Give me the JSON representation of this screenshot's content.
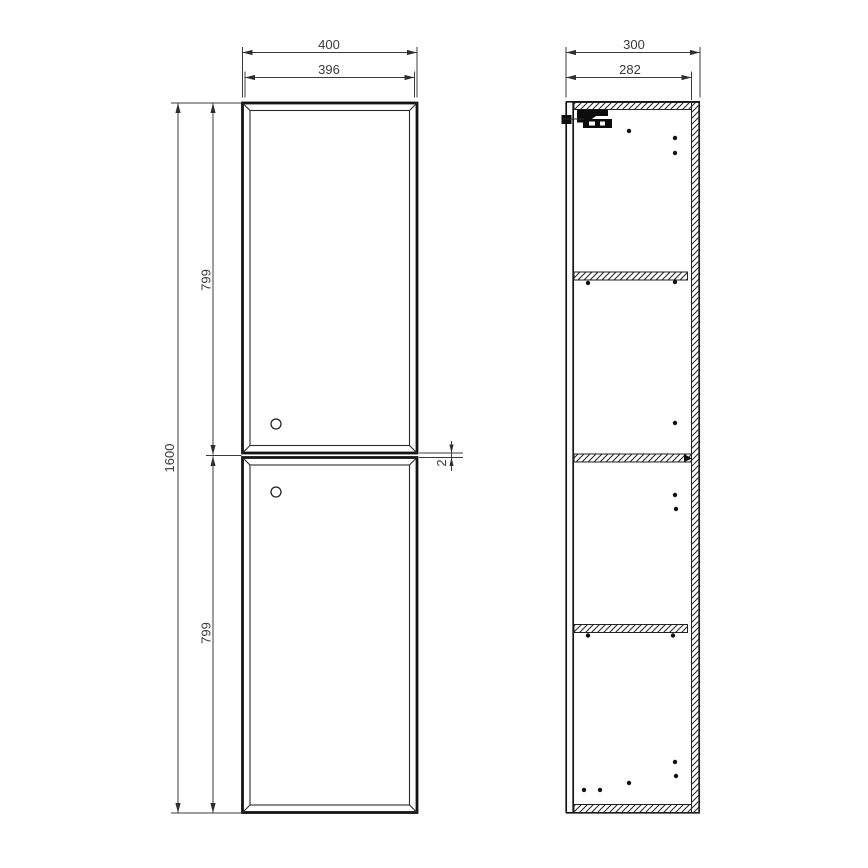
{
  "front_view": {
    "dim_width_outer": "400",
    "dim_width_door": "396",
    "dim_height_total": "1600",
    "dim_upper_door_height": "799",
    "dim_lower_door_height": "799",
    "dim_door_gap": "2"
  },
  "side_view": {
    "dim_depth_outer": "300",
    "dim_depth_inner": "282"
  },
  "colors": {
    "drawing_line": "#141414",
    "dimension_line": "#3c3c3c",
    "background": "#ffffff"
  }
}
